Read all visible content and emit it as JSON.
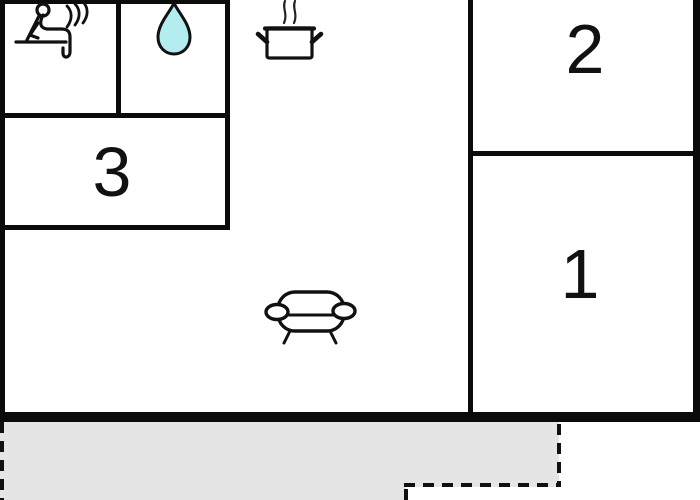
{
  "plan": {
    "title": "apartment-floor-plan",
    "rooms": [
      {
        "name": "room-2",
        "label": "2"
      },
      {
        "name": "room-1",
        "label": "1"
      },
      {
        "name": "room-3",
        "label": "3"
      }
    ],
    "icons": [
      {
        "name": "sauna-icon",
        "meaning": "sauna"
      },
      {
        "name": "water-drop-icon",
        "meaning": "bathroom / water"
      },
      {
        "name": "cooking-pot-icon",
        "meaning": "kitchen"
      },
      {
        "name": "sofa-icon",
        "meaning": "living room"
      }
    ],
    "colors": {
      "wall": "#0b0b0b",
      "water_drop_fill": "#b3edf0",
      "terrace_fill": "#e5e5e5",
      "background": "#ffffff"
    }
  }
}
